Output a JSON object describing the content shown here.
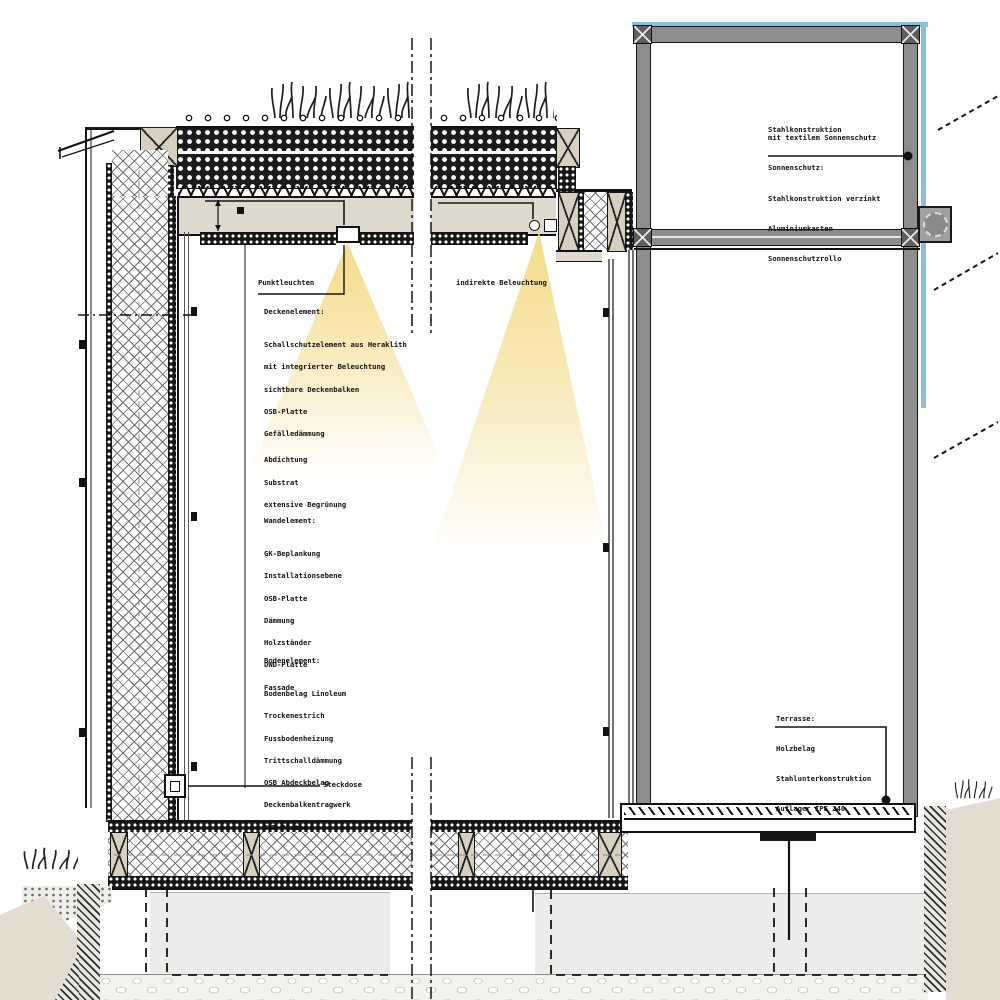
{
  "drawing": {
    "type": "architectural-section-detail",
    "colors": {
      "sunscreen_blue": "#8cbede",
      "light_yellow": "#f3d984",
      "steel_gray": "#8d8d8d",
      "wood_beige": "#d7d0be",
      "line_black": "#141414"
    }
  },
  "labels": {
    "punktleuchten": "Punktleuchten",
    "indirekte_beleuchtung": "indirekte Beleuchtung",
    "steckdose": "Steckdose",
    "deckenelement": {
      "heading": "Deckenelement:",
      "lines": [
        "Schallschutzelement aus Heraklith",
        "mit integrierter Beleuchtung",
        "sichtbare Deckenbalken",
        "OSB-Platte",
        "Gefälledämmung",
        "Abdichtung",
        "Substrat",
        "extensive Begrünung"
      ]
    },
    "wandelement": {
      "heading": "Wandelement:",
      "lines": [
        "GK-Beplankung",
        "Installationsebene",
        "OSB-Platte",
        "Dämmung",
        "Holzständer",
        "DWD-Platte",
        "Fassade"
      ]
    },
    "bodenelement": {
      "heading": "Bodenelement:",
      "lines": [
        "Bodenbelag Linoleum",
        "Trockenestrich",
        "Fussbodenheizung",
        "Trittschalldämmung",
        "OSB Abdeckbelag",
        "Deckenbalkentragwerk",
        "DWD Platte"
      ]
    },
    "sonnenschutz_callout": {
      "line1": "Stahlkonstruktion",
      "line2": "mit textilem Sonnenschutz"
    },
    "sonnenschutz": {
      "heading": "Sonnenschutz:",
      "lines": [
        "Stahlkonstruktion verzinkt",
        "Aluminiumkasten",
        "Sonnenschutzrollo"
      ]
    },
    "terrasse": {
      "heading": "Terrasse:",
      "lines": [
        "Holzbelag",
        "Stahlunterkonstruktion",
        "Auflager IPE 240"
      ]
    }
  }
}
